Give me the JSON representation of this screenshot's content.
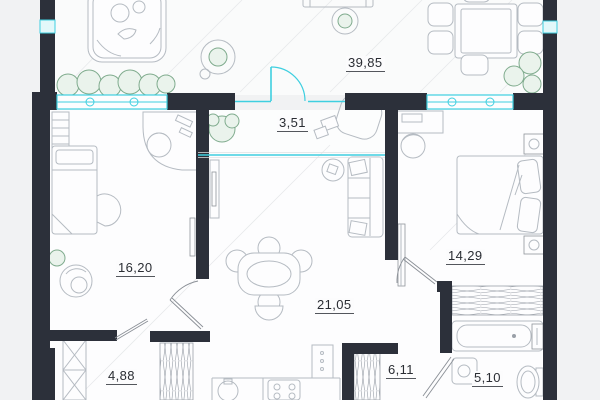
{
  "plan": {
    "title": "apartment-floor-plan",
    "rooms": [
      {
        "name": "terrace",
        "area": "39,85"
      },
      {
        "name": "balcony",
        "area": "3,51"
      },
      {
        "name": "room-left",
        "area": "16,20"
      },
      {
        "name": "bedroom-right",
        "area": "14,29"
      },
      {
        "name": "living-kitchen",
        "area": "21,05"
      },
      {
        "name": "hallway",
        "area": "4,88"
      },
      {
        "name": "corridor",
        "area": "6,11"
      },
      {
        "name": "bathroom",
        "area": "5,10"
      }
    ],
    "colors": {
      "wall": "#2c303a",
      "glazing": "#3ecfe0",
      "furniture_line": "#b5bbc2",
      "plant": "#7fab8d",
      "floor": "#fdfdfe",
      "background_outside": "#f1f2f3",
      "label_text": "#2a2d33"
    }
  }
}
